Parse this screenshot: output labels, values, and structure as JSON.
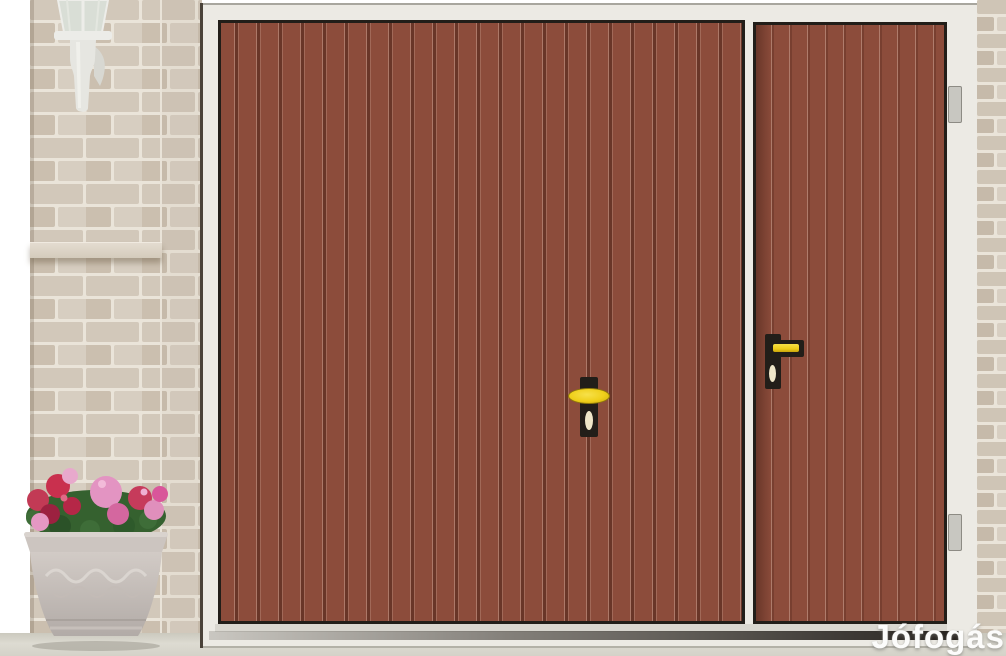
{
  "watermark": {
    "text": "Jófogás"
  },
  "objects": {
    "lamp": "white-wall-lantern",
    "wall": "beige-brick-wall",
    "planter": "stone-planter-with-pink-and-red-flowers",
    "garage_door": "brown-vertical-panel-garage-door",
    "side_door": "brown-vertical-panel-side-door",
    "garage_handle": "yellow-oval-t-handle-with-keyhole",
    "side_handle": "yellow-lever-handle-with-keyhole",
    "hinges": "two-gray-hinges-on-side-door-right-jamb"
  },
  "colors": {
    "door_base": "#8C4C3B",
    "door_dark": "#703A2B",
    "door_light": "#A97965",
    "frame_white": "#ECEAE4",
    "outline": "#221E19",
    "brick": "#D2C8BA",
    "brick_dark": "#CBBFAF",
    "brick_light": "#D7CEC1",
    "mortar": "#EAE4D9",
    "ground": "#D3D1C6",
    "ground_shadow": "#B3B1A7",
    "lamp_white": "#ECECE8",
    "lamp_glass": "#D9DED6",
    "pot": "#CCC5C0",
    "pot_dark": "#B2ABA7",
    "leaf": "#3E6D38",
    "leaf_dark": "#2B5228",
    "flower_pink": "#E598C3",
    "flower_pink_deep": "#D4679F",
    "flower_red": "#C23A55",
    "flower_red_dark": "#9C2140",
    "handle_yellow": "#EFCF1A",
    "keyhole_cream": "#EFE6C8",
    "hinge_gray": "#C8C7C1",
    "watermark_white": "#FCFCFB"
  }
}
